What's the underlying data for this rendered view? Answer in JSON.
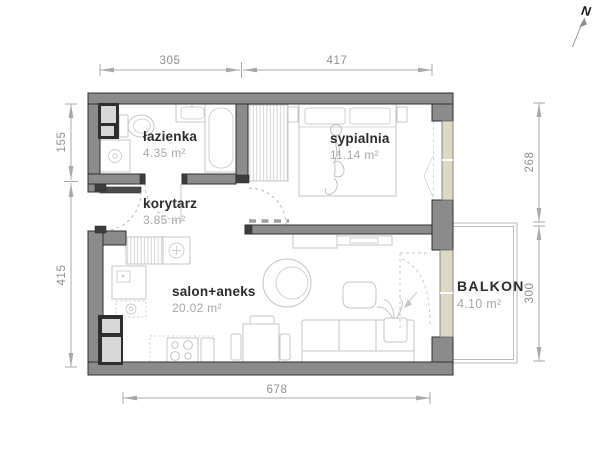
{
  "north": {
    "label": "N"
  },
  "rooms": {
    "lazienka": {
      "name": "łazienka",
      "area": "4.35 m²"
    },
    "korytarz": {
      "name": "korytarz",
      "area": "3.85 m²"
    },
    "sypialnia": {
      "name": "sypialnia",
      "area": "11.14 m²"
    },
    "salon": {
      "name": "salon+aneks",
      "area": "20.02 m²"
    },
    "balkon": {
      "name": "BALKON",
      "area": "4.10 m²"
    }
  },
  "dimensions_cm": {
    "top_left": "305",
    "top_right": "417",
    "left_upper": "155",
    "left_lower": "415",
    "right_upper": "268",
    "right_lower": "300",
    "bottom": "678"
  },
  "colors": {
    "wall": "#8b8b8b",
    "wall_dark": "#3d3d3d",
    "window": "#ddd7c6",
    "dimension": "#9c9c9c",
    "furniture": "#c4c4c4",
    "room_name": "#2b2b2b",
    "room_area": "#a8a8a8"
  }
}
